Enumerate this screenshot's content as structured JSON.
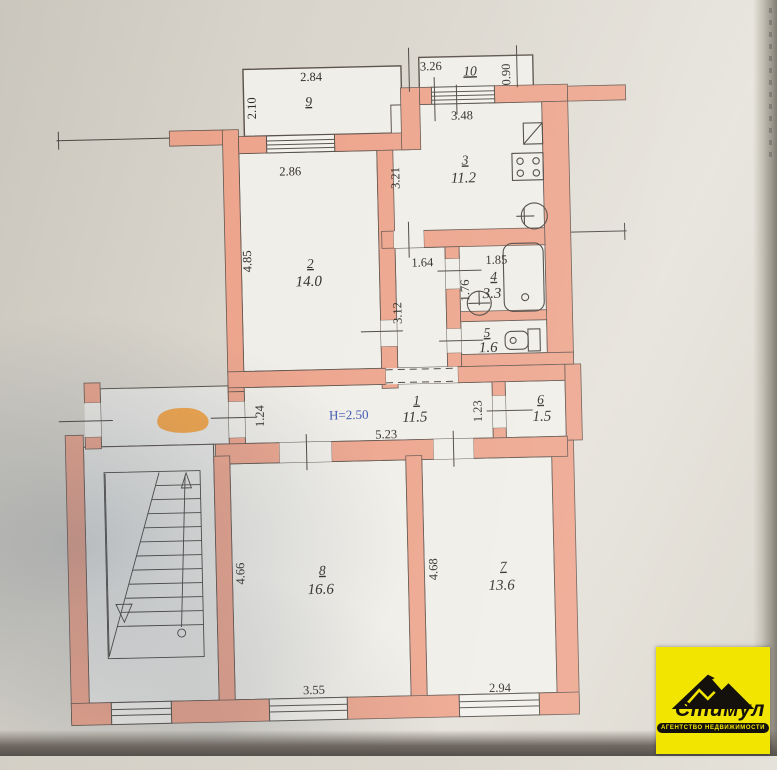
{
  "plan": {
    "hall_height_note": "H=2.50",
    "rooms": {
      "r1": {
        "num": "1",
        "area": "11.5"
      },
      "r2": {
        "num": "2",
        "area": "14.0"
      },
      "r3": {
        "num": "3",
        "area": "11.2"
      },
      "r4": {
        "num": "4",
        "area": "3.3"
      },
      "r5": {
        "num": "5",
        "area": "1.6"
      },
      "r6": {
        "num": "6",
        "area": "1.5"
      },
      "r7": {
        "num": "7",
        "area": "13.6"
      },
      "r8": {
        "num": "8",
        "area": "16.6"
      },
      "r9": {
        "num": "9"
      },
      "r10": {
        "num": "10"
      }
    },
    "dims": {
      "balcony9_w": "2.84",
      "balcony9_d": "2.10",
      "balcony10_w": "3.26",
      "balcony10_d": "0.90",
      "kitchen_window_w": "3.48",
      "kitchen_d": "3.21",
      "room2_window_w": "2.86",
      "room2_d": "4.85",
      "corridor_w": "1.64",
      "corridor_d": "3.12",
      "bath_w": "1.85",
      "bath_d": "1.76",
      "hall_w": "5.23",
      "hall_left_d": "1.24",
      "hall_right_d": "1.23",
      "room8_d": "4.66",
      "room8_w": "3.55",
      "room7_d": "4.68",
      "room7_w": "2.94"
    }
  },
  "logo": {
    "brand": "Стимул",
    "tagline": "АГЕНТСТВО НЕДВИЖИМОСТИ"
  },
  "colors": {
    "wall": "#eda58d",
    "paper": "#d8d4cb",
    "note_blue": "#3b55b0",
    "marker_orange": "#f3a243",
    "logo_yellow": "#f2e600"
  }
}
